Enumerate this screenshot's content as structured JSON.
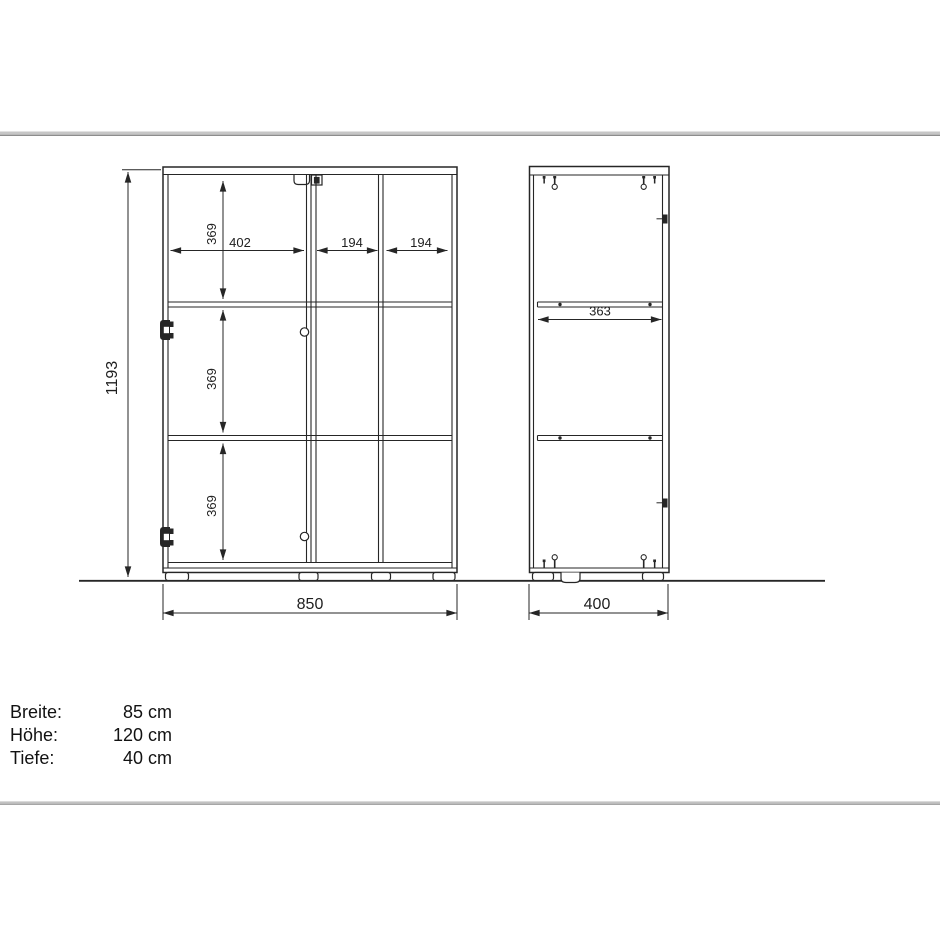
{
  "diagram": {
    "front_view": {
      "overall_height": "1193",
      "overall_width": "850",
      "section_heights": [
        "369",
        "369",
        "369"
      ],
      "section_widths": [
        "402",
        "194",
        "194"
      ]
    },
    "side_view": {
      "shelf_depth": "363",
      "overall_depth": "400"
    }
  },
  "specs": {
    "rows": [
      {
        "label": "Breite:",
        "value": "85 cm"
      },
      {
        "label": "Höhe:",
        "value": "120 cm"
      },
      {
        "label": "Tiefe:",
        "value": "40 cm"
      }
    ]
  },
  "colors": {
    "line": "#262626",
    "rule": "#c6c6c6"
  }
}
